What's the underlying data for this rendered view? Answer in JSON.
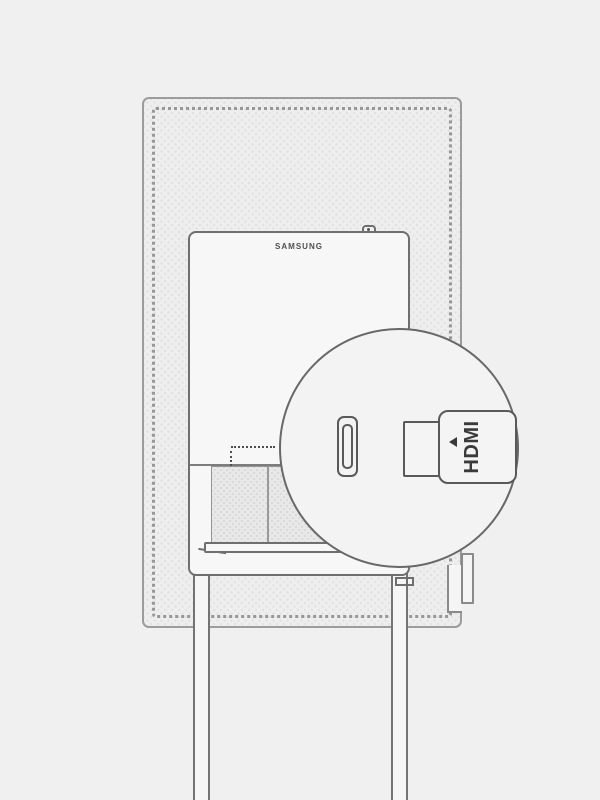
{
  "illustration": {
    "type": "device-connection-diagram",
    "device": "monitor-rear-view",
    "brand_label": "SAMSUNG",
    "magnifier": {
      "port_icon": "hdmi-port",
      "plug_icon": "hdmi-plug",
      "plug_label": "HDMI",
      "plug_label_rotation_deg": -90,
      "arrow_icon": "insert-direction-arrow-left"
    },
    "colors": {
      "background": "#f0f0f0",
      "monitor_fill": "#eeeeee",
      "monitor_border": "#9c9c9c",
      "panel_fill": "#f7f7f7",
      "panel_border": "#6f6f6f",
      "circle_fill": "#f3f3f3",
      "circle_border": "#686868",
      "connector_outline": "#595959",
      "label_text": "#3a3a3a",
      "brand_text": "#4f4f4f"
    }
  }
}
